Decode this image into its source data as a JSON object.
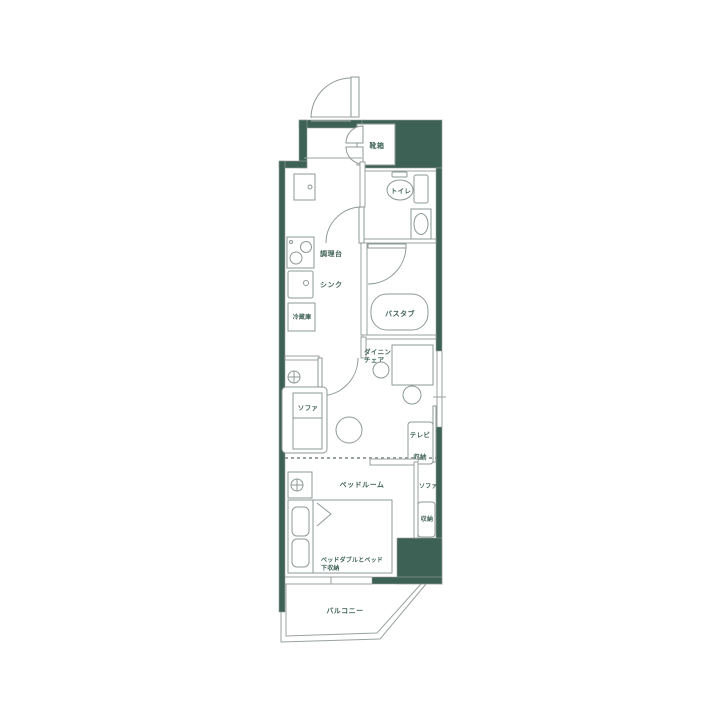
{
  "floorplan": {
    "background": "#ffffff",
    "wall_color": "#3E6156",
    "line_color": "#9AA29D",
    "text_color": "#3F6257",
    "labels": {
      "shoe_box": "靴箱",
      "toilet": "トイレ",
      "kitchen_counter": "調理台",
      "sink": "シンク",
      "refrigerator": "冷蔵庫",
      "bathtub": "バスタブ",
      "dining_table_line1": "ダイニングテーブル&",
      "dining_table_line2": "チェア",
      "sofa": "ソファ",
      "tv": "テレビ",
      "tv_storage": "収納",
      "bedroom": "ベッドルーム",
      "bedroom_sofa": "ソファ",
      "bedroom_storage": "収納",
      "bed_line1": "ベッドダブルとベッド",
      "bed_line2": "下収納",
      "balcony": "バルコニー"
    }
  }
}
